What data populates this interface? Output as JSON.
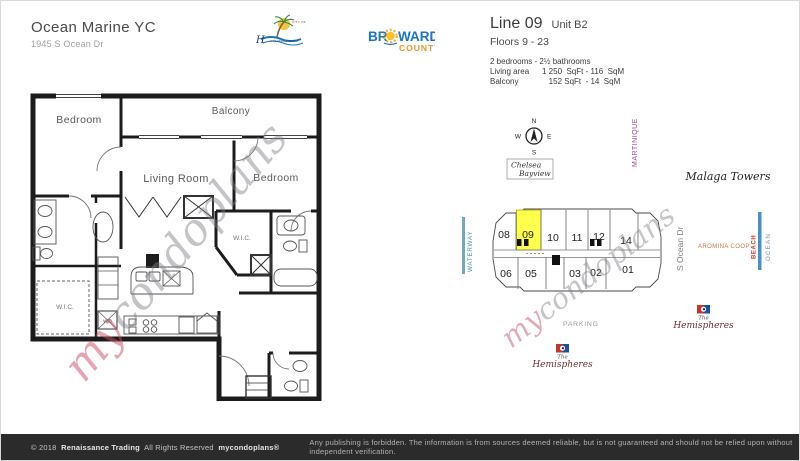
{
  "header": {
    "title": "Ocean Marine YC",
    "address": "1945 S Ocean Dr",
    "line": "Line 09",
    "unit": "Unit B2",
    "floors": "Floors 9 - 23",
    "bed_bath": "2 bedrooms - 2½ bathrooms",
    "living_label": "Living area",
    "living_value": "1 250  SqFt - 116  SqM",
    "balcony_label": "Balcony",
    "balcony_value": "   152 SqFt  - 14  SqM",
    "hallandale": {
      "city_of": "CITY OF",
      "h": "H",
      "name_small": "HALLANDALE BEACH"
    },
    "broward": {
      "br": "BR",
      "ward": "WARD",
      "county": "COUNTY"
    }
  },
  "floorplan": {
    "bedroom1": "Bedroom",
    "balcony": "Balcony",
    "living": "Living Room",
    "bedroom2": "Bedroom",
    "wic": "W.I.C.",
    "wd": "W/D",
    "watermark": {
      "my": "my",
      "rest": "condoplans"
    }
  },
  "site": {
    "compass": {
      "n": "N",
      "s": "S",
      "e": "E",
      "w": "W"
    },
    "chelsea1": "Chelsea",
    "chelsea2": "Bayview",
    "martinique": "MARTINIQUE",
    "malaga": "Malaga Towers",
    "aromina": "AROMINA COOP",
    "waterway": "WATERWAY",
    "s_ocean": "S Ocean Dr",
    "beach": "BEACH",
    "ocean": "OCEAN",
    "parking": "PARKING",
    "hemi": {
      "the": "The",
      "name": "Hemispheres"
    },
    "units_top": [
      "08",
      "09",
      "10",
      "11",
      "12",
      "14"
    ],
    "units_bottom": [
      "06",
      "05",
      "03",
      "02",
      "01"
    ],
    "highlighted_unit": "09",
    "watermark": {
      "my": "my",
      "rest": "condoplans"
    },
    "colors": {
      "highlight": "#ffff4d",
      "waterway_line": "#6fa8bf",
      "beach_line": "#4a90c4",
      "beach_text": "#bf3a2b",
      "martinique_text": "#9b4a9b",
      "aromina_text": "#c8744a"
    }
  },
  "footer": {
    "year": "© 2018",
    "company": "Renaissance Trading",
    "rights": "All Rights Reserved",
    "brand": "mycondoplans®",
    "right": "Any publishing is forbidden.  The information is from sources deemed reliable, but is not guaranteed and should not be relied upon without independent verification."
  }
}
